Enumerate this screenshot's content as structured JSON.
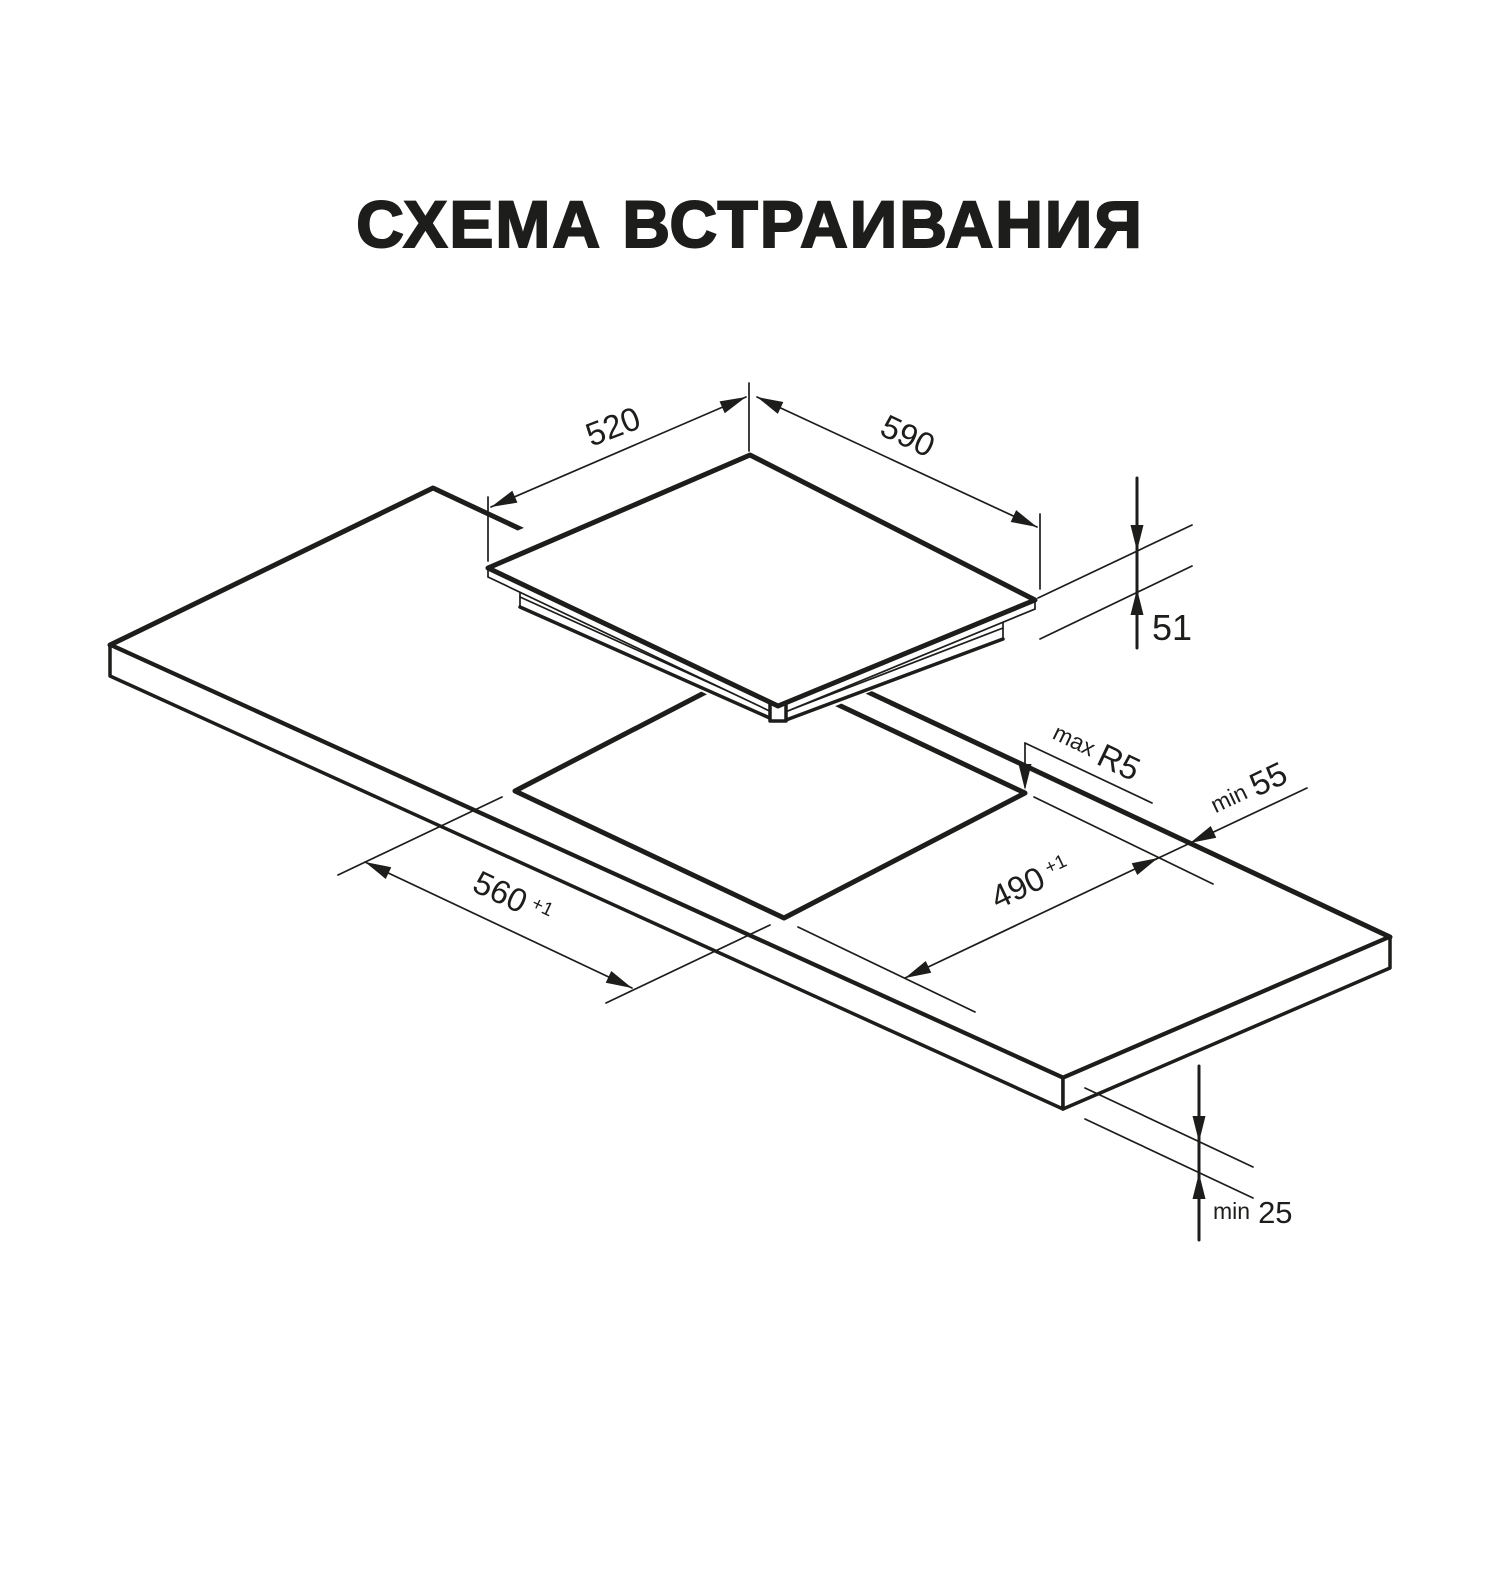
{
  "title": "СХЕМА ВСТРАИВАНИЯ",
  "colors": {
    "ink": "#1d1d1b",
    "background": "#ffffff"
  },
  "dimensions": {
    "cooktop_depth": {
      "value": "520"
    },
    "cooktop_width": {
      "value": "590"
    },
    "cooktop_height": {
      "value": "51"
    },
    "corner_radius": {
      "prefix": "max",
      "value": "R5"
    },
    "edge_clearance": {
      "prefix": "min",
      "value": "55"
    },
    "cutout_width": {
      "value": "560",
      "tolerance": "+1"
    },
    "cutout_depth": {
      "value": "490",
      "tolerance": "+1"
    },
    "worktop_thickness": {
      "prefix": "min",
      "value": "25"
    }
  }
}
